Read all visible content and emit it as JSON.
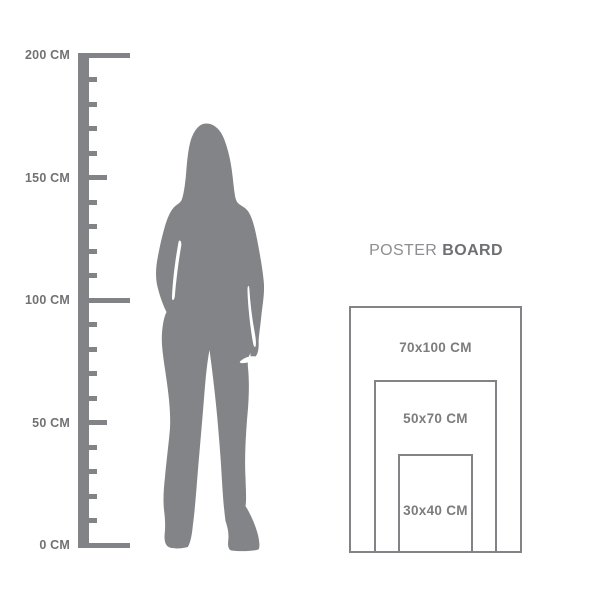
{
  "colors": {
    "background": "#ffffff",
    "figure": "#838487",
    "line": "#828386",
    "ruler_text": "#717274",
    "size_text": "#7b7c7e",
    "title_regular": "#8d8e90",
    "title_bold": "#6f7073"
  },
  "ruler": {
    "unit": "CM",
    "max_cm": 200,
    "tick_interval_cm": 10,
    "mid_interval_cm": 50,
    "major_interval_cm": 100,
    "labels": [
      {
        "value": 200,
        "text": "200 CM"
      },
      {
        "value": 150,
        "text": "150 CM"
      },
      {
        "value": 100,
        "text": "100 CM"
      },
      {
        "value": 50,
        "text": "50 CM"
      },
      {
        "value": 0,
        "text": "0 CM"
      }
    ]
  },
  "figure": {
    "name": "female-silhouette"
  },
  "poster_board": {
    "title_regular": "POSTER",
    "title_bold": "BOARD",
    "sizes": [
      {
        "label": "70x100 CM",
        "width_cm": 70,
        "height_cm": 100
      },
      {
        "label": "50x70 CM",
        "width_cm": 50,
        "height_cm": 70
      },
      {
        "label": "30x40 CM",
        "width_cm": 30,
        "height_cm": 40
      }
    ]
  }
}
